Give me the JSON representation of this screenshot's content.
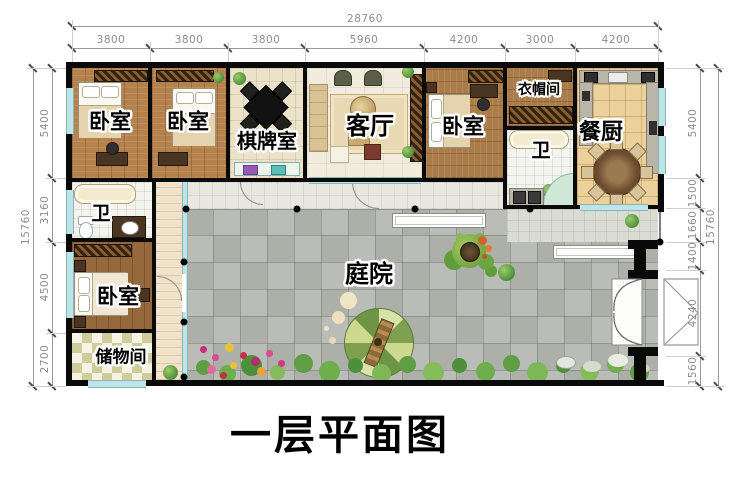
{
  "title": "一层平面图",
  "rooms": {
    "bedroom_1": "卧室",
    "bedroom_2": "卧室",
    "chess_room": "棋牌室",
    "living_room": "客厅",
    "bedroom_3": "卧室",
    "cloakroom": "衣帽间",
    "bathroom_1": "卫",
    "dining_kitchen": "餐厨",
    "bathroom_2": "卫",
    "bedroom_4": "卧室",
    "storage": "储物间",
    "courtyard": "庭院"
  },
  "dimensions": {
    "top": {
      "total": "28760",
      "segments": [
        "3800",
        "3800",
        "3800",
        "5960",
        "4200",
        "3000",
        "4200"
      ]
    },
    "left": {
      "total": "15760",
      "segments": [
        "5400",
        "3160",
        "4500",
        "2700"
      ]
    },
    "right": {
      "total": "15760",
      "segments": [
        "5400",
        "1500",
        "1660",
        "1400",
        "4240",
        "1560"
      ]
    }
  },
  "colors": {
    "wall": "#0a0a0a",
    "wood_floor": "#b5824e",
    "dining_tile": "#ecd29a",
    "paver_gray": "#b6b9b2",
    "window_glass": "#bfe3e6",
    "plant_green": "#4e8f3c",
    "dimension_text": "#8d8d8d"
  }
}
